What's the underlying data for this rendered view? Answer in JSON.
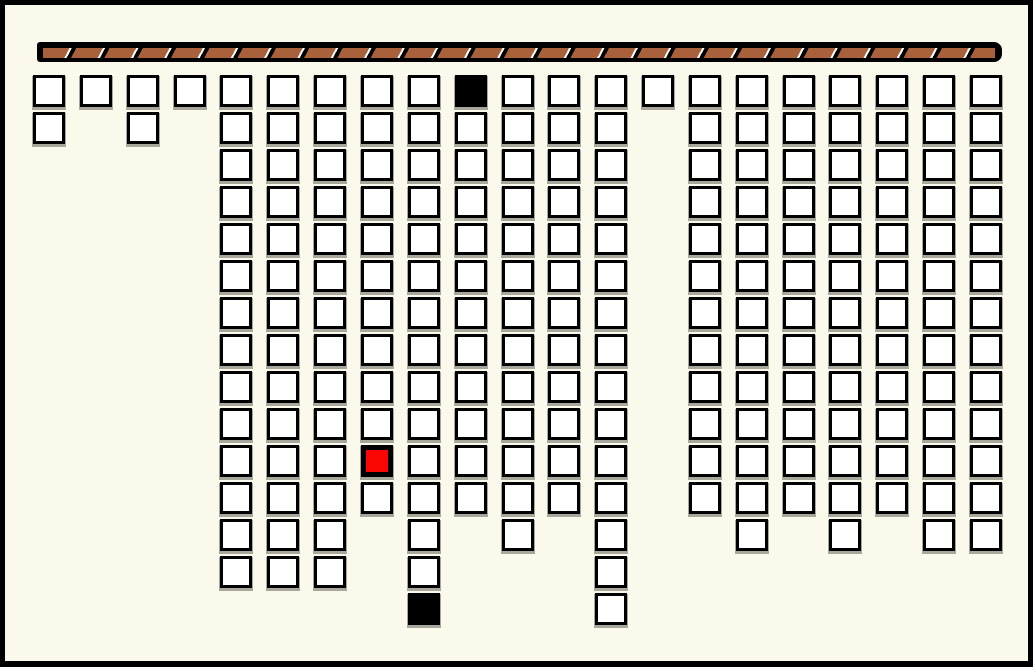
{
  "window": {
    "width": 1033,
    "height": 667,
    "background": "#FBF9EC",
    "frame_color": "#000000",
    "frame_thickness": 5
  },
  "rod": {
    "x": 37,
    "y": 42,
    "width": 965,
    "height": 20,
    "casing_color": "#000000",
    "fill_color": "#A9613C",
    "stripe_dark": "#000000",
    "stripe_light": "#FFFFFF",
    "segment_period_px": 33,
    "segment_count": 29
  },
  "board": {
    "origin_x": 33,
    "origin_y": 75,
    "cell_size": 32,
    "col_spacing": 46.85,
    "row_spacing": 37,
    "num_columns": 21,
    "max_rows": 15,
    "columns": [
      {
        "col": 1,
        "depth": 2
      },
      {
        "col": 2,
        "depth": 1
      },
      {
        "col": 3,
        "depth": 2
      },
      {
        "col": 4,
        "depth": 1
      },
      {
        "col": 5,
        "depth": 14
      },
      {
        "col": 6,
        "depth": 14
      },
      {
        "col": 7,
        "depth": 14
      },
      {
        "col": 8,
        "depth": 12
      },
      {
        "col": 9,
        "depth": 15
      },
      {
        "col": 10,
        "depth": 12
      },
      {
        "col": 11,
        "depth": 13
      },
      {
        "col": 12,
        "depth": 12
      },
      {
        "col": 13,
        "depth": 15
      },
      {
        "col": 14,
        "depth": 1
      },
      {
        "col": 15,
        "depth": 12
      },
      {
        "col": 16,
        "depth": 13
      },
      {
        "col": 17,
        "depth": 12
      },
      {
        "col": 18,
        "depth": 13
      },
      {
        "col": 19,
        "depth": 12
      },
      {
        "col": 20,
        "depth": 13
      },
      {
        "col": 21,
        "depth": 13
      }
    ],
    "special_cells": [
      {
        "col": 10,
        "row": 1,
        "state": "black"
      },
      {
        "col": 8,
        "row": 11,
        "state": "red"
      },
      {
        "col": 9,
        "row": 15,
        "state": "black"
      }
    ]
  },
  "colors": {
    "window-bg": "#FBF9EC",
    "frame-color": "#000000",
    "rod-casing": "#000000",
    "rod-fill": "#A9613C",
    "rod-stripe-dark": "#000000",
    "rod-stripe-light": "#FFFFFF",
    "cell-fill": "#FFFFFF",
    "cell-border": "#000000",
    "cell-shadow": "#A7A79C",
    "cell-black": "#000000",
    "cell-red": "#FB0505"
  }
}
